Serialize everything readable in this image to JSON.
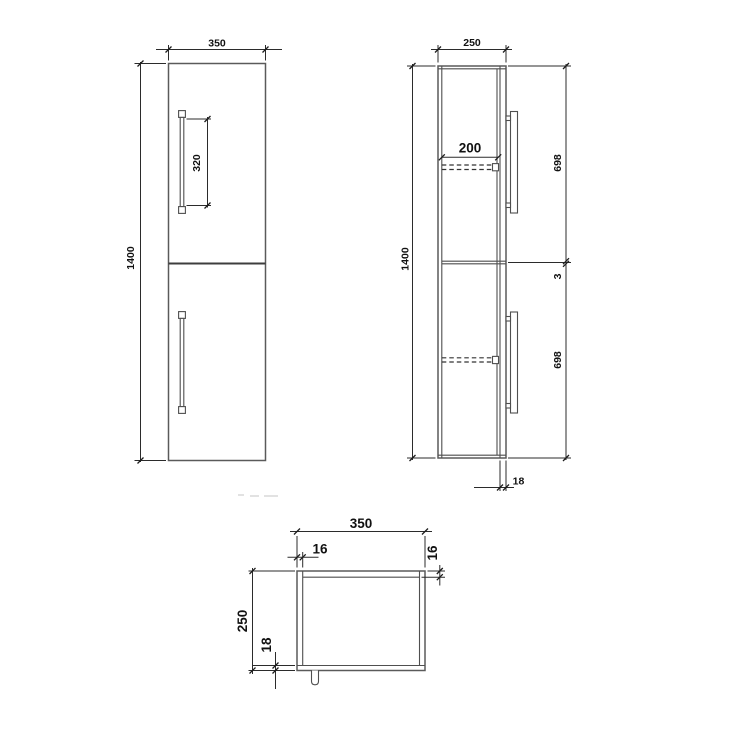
{
  "canvas": {
    "width": 750,
    "height": 750,
    "background": "#ffffff"
  },
  "colors": {
    "outline": "#5a5a5a",
    "detail_line": "#4f4f4f",
    "dimension_line": "#2b2b2b",
    "label_text": "#111111"
  },
  "views": {
    "front": {
      "labels": {
        "width": "350",
        "height": "1400",
        "handle_length": "320"
      }
    },
    "side": {
      "labels": {
        "depth": "250",
        "height": "1400",
        "shelf_depth": "200",
        "upper_door_height": "698",
        "door_gap": "3",
        "lower_door_height": "698",
        "panel_thickness": "18"
      }
    },
    "top": {
      "labels": {
        "width": "350",
        "side_panel_thickness": "16",
        "back_panel_thickness": "16",
        "depth": "250",
        "front_panel_thickness": "18"
      }
    }
  }
}
